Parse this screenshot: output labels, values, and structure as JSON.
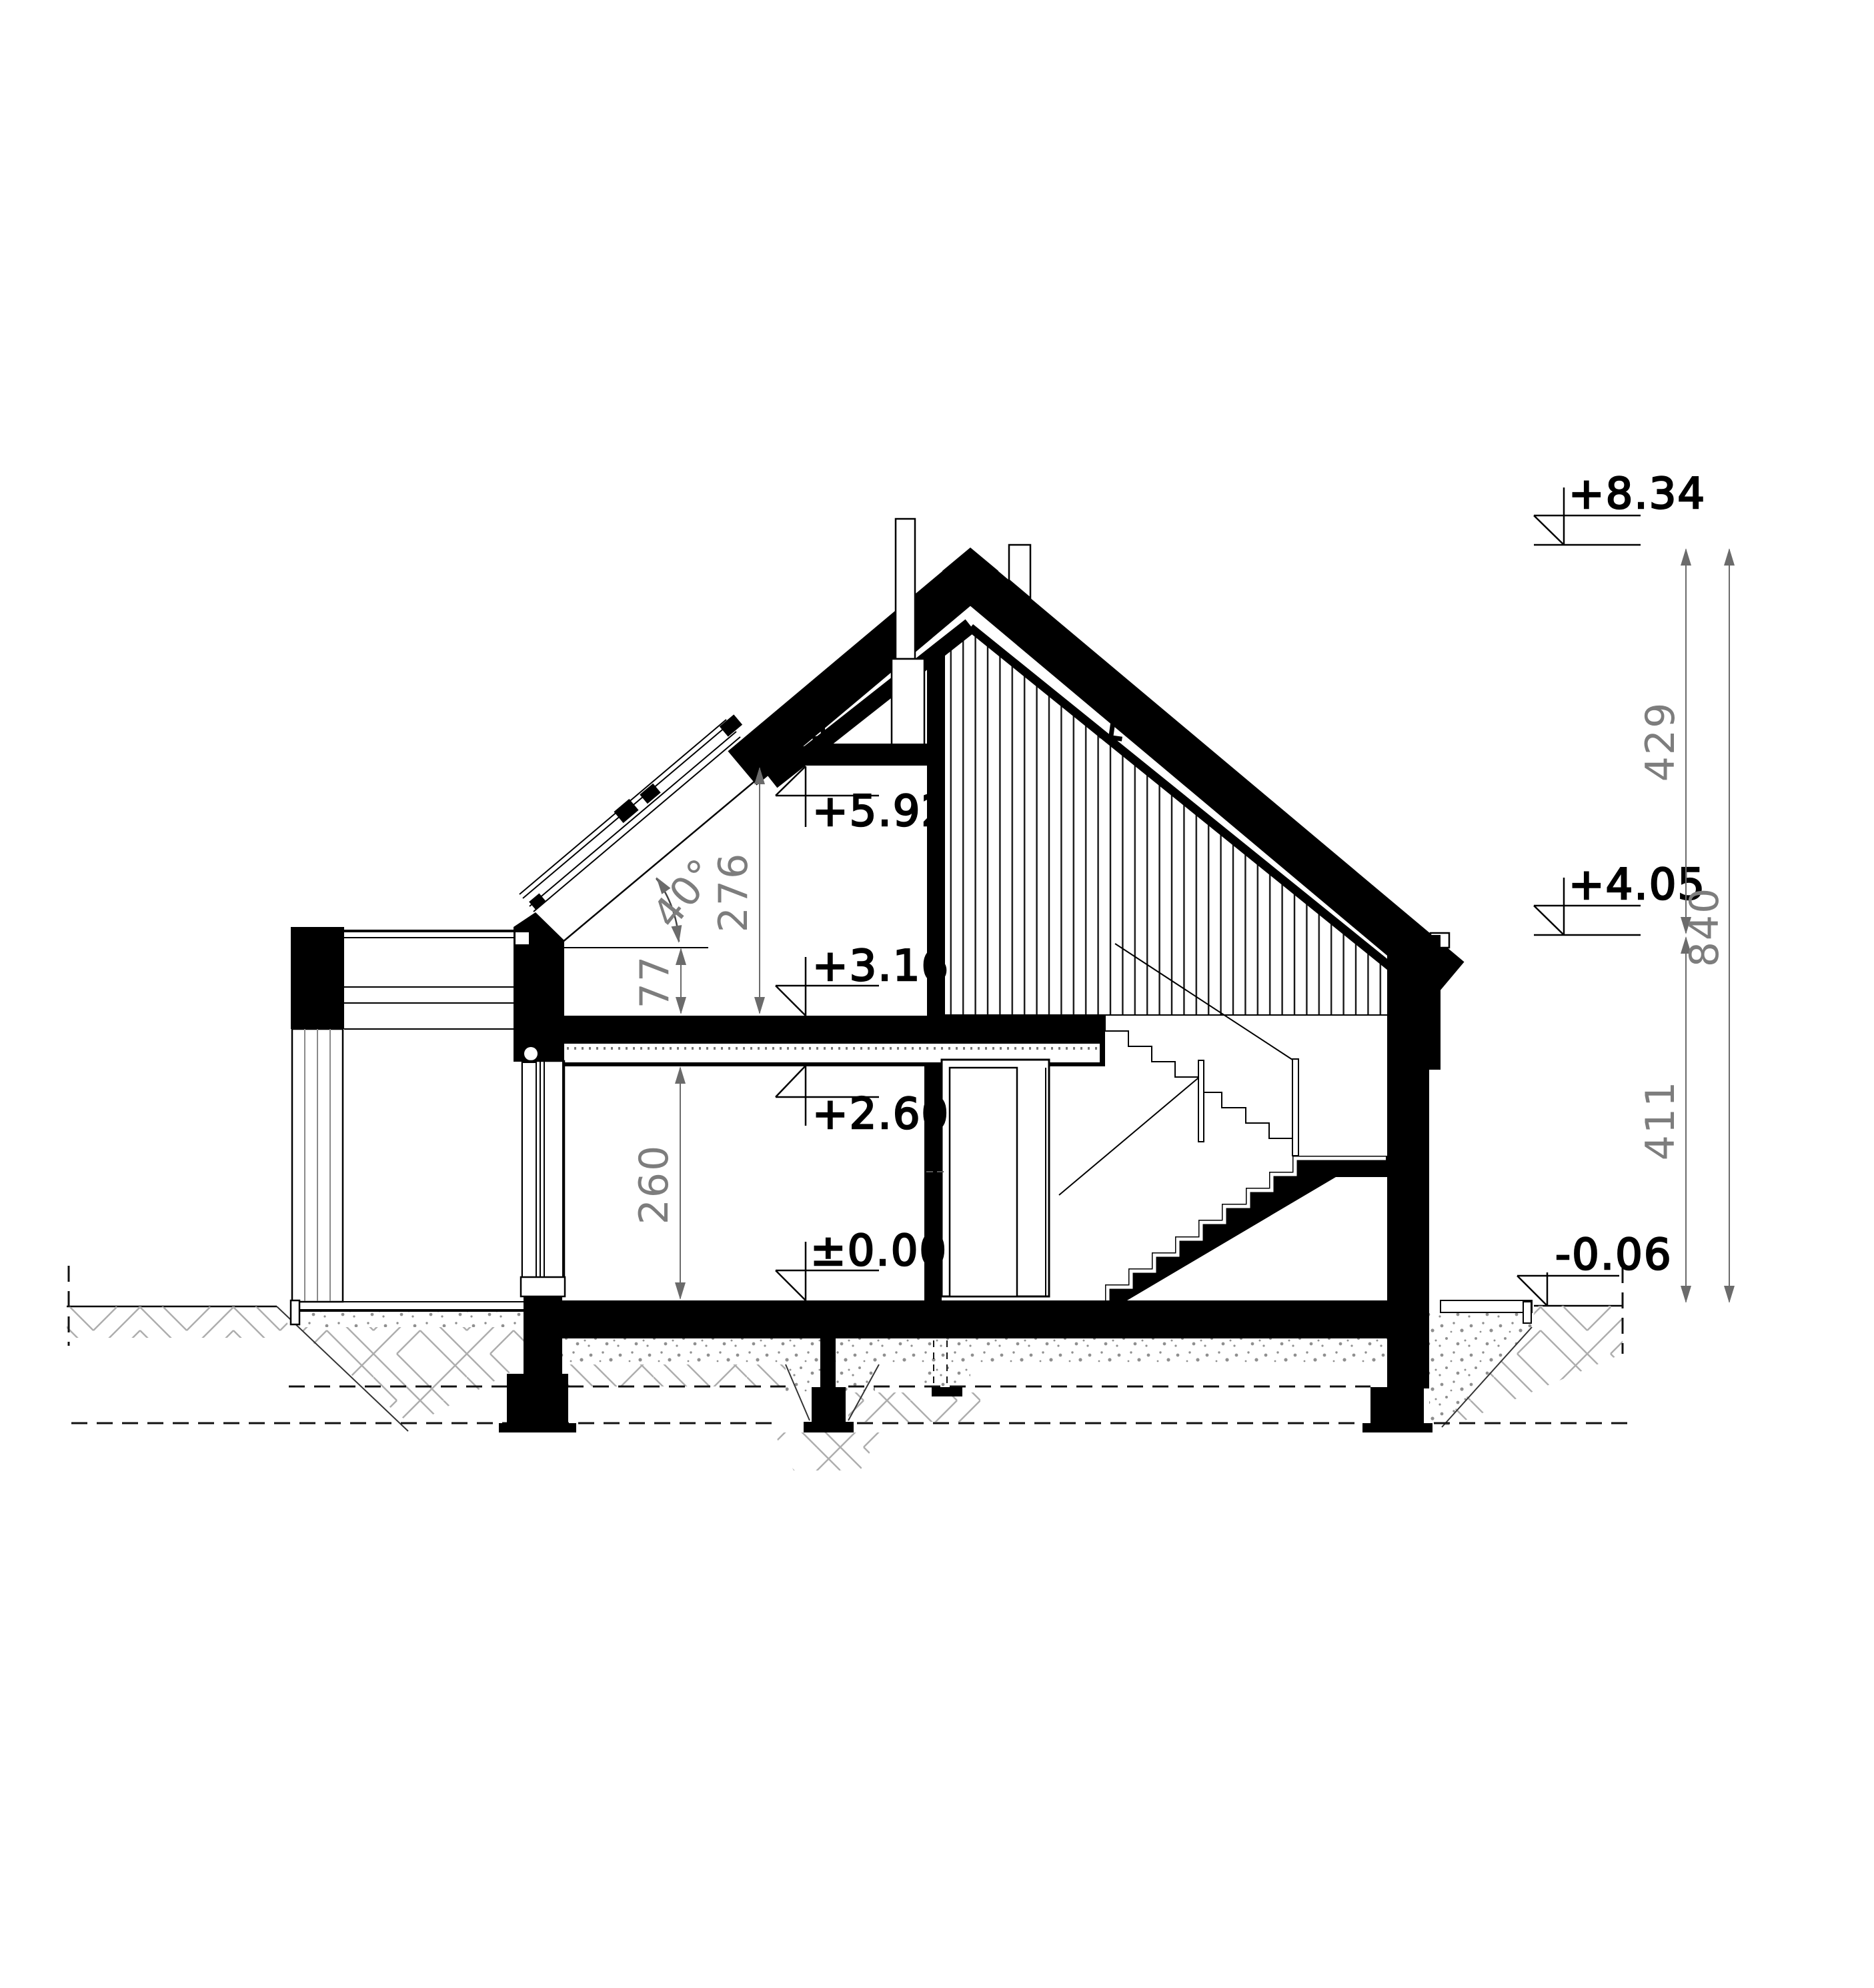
{
  "drawing": {
    "type": "architectural cross-section",
    "levels": {
      "ridge": "+8.34",
      "eave": "+4.05",
      "terrain": "-0.06",
      "collar_ceiling": "+5.92",
      "attic_floor": "+3.16",
      "ground_ceiling": "+2.60",
      "ground_floor": "±0.00"
    },
    "dims": {
      "roof_zone": "429",
      "wall_zone": "411",
      "total_height": "840",
      "attic_room": "276",
      "ground_room": "260",
      "knee_wall": "77",
      "roof_pitch": "40°"
    },
    "colors": {
      "ink": "#000000",
      "dimension": "#6b6b6b",
      "hatch": "#adadad",
      "sand": "#8f8f8f"
    }
  }
}
